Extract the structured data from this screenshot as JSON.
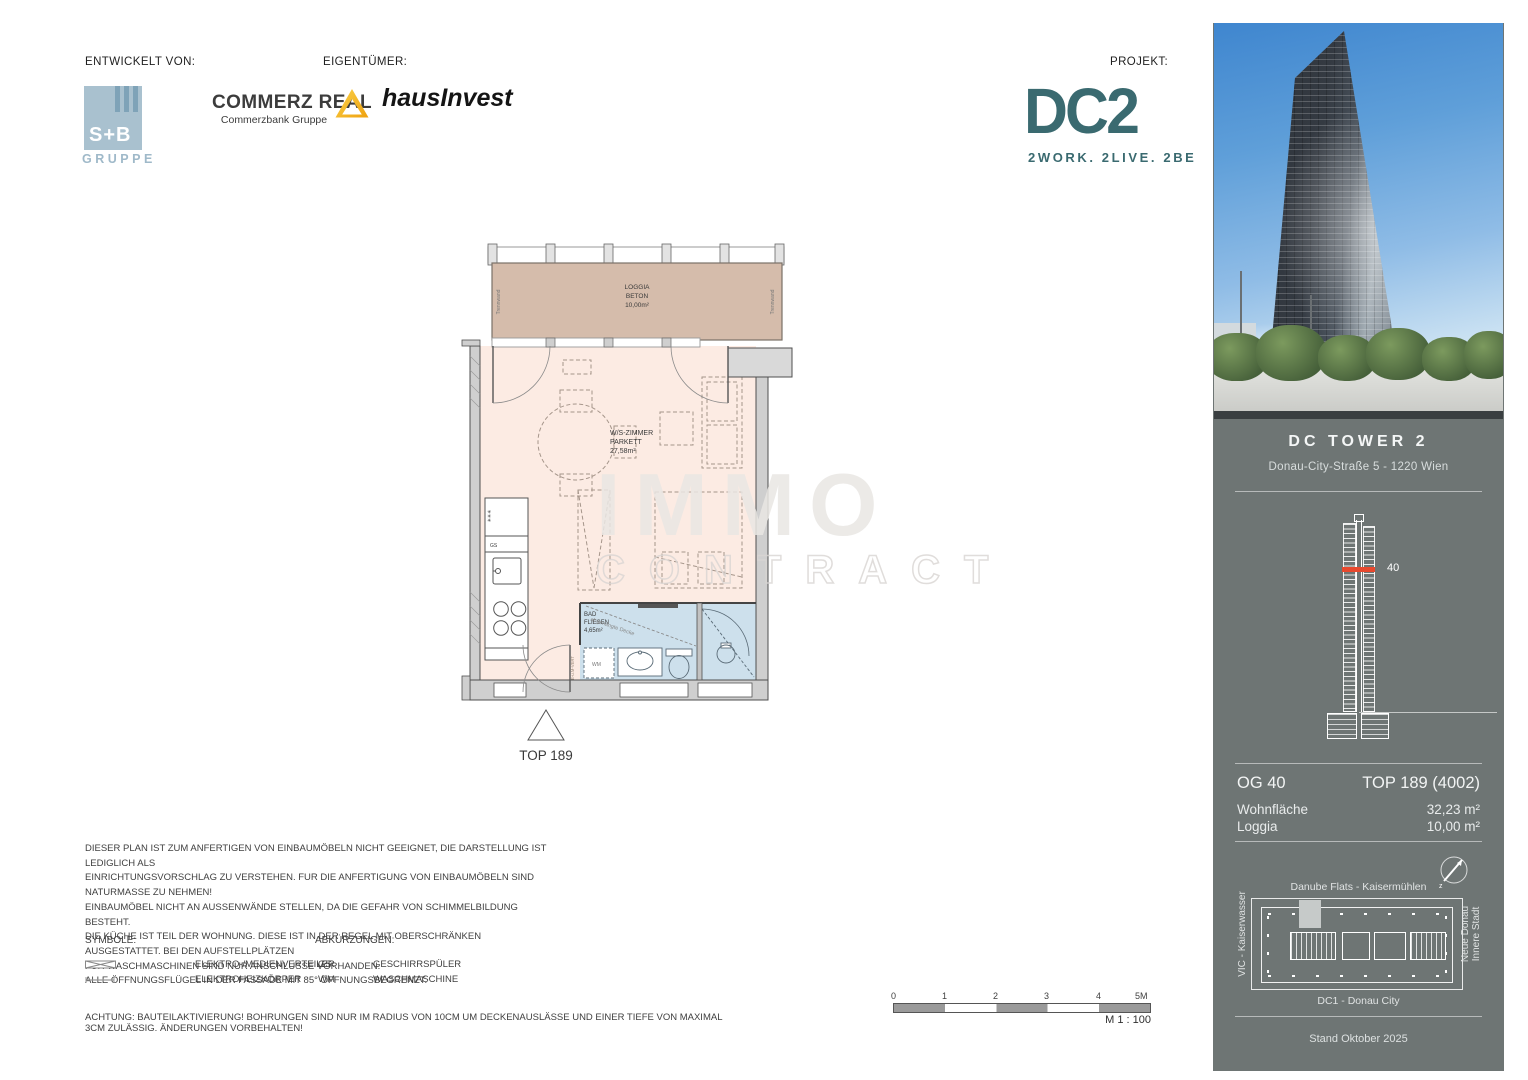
{
  "header": {
    "developed_by_label": "ENTWICKELT VON:",
    "owner_label": "EIGENTÜMER:",
    "project_label": "PROJEKT:",
    "sb_logo": {
      "name": "S+B",
      "sub": "GRUPPE"
    },
    "commerz": {
      "name": "COMMERZ REAL",
      "sub": "Commerzbank Gruppe"
    },
    "hausinvest": "hausInvest",
    "dc2": {
      "name": "DC2",
      "tagline": "2WORK. 2LIVE. 2BE"
    }
  },
  "floorplan": {
    "loggia": {
      "name": "LOGGIA",
      "surface": "BETON",
      "area": "10,00m²"
    },
    "trennwand": "Trennwand",
    "room": {
      "name": "W/S-ZIMMER",
      "surface": "PARKETT",
      "area": "27,58m²"
    },
    "bath": {
      "name": "BAD",
      "surface": "FLIESEN",
      "area": "4,65m²",
      "ceiling_note": "abgehängte Decke"
    },
    "labels": {
      "gs": "GS",
      "wm": "WM",
      "e_vert": "E-u.M-VERT",
      "fridge": "✳✳✳"
    },
    "unit": "TOP 189"
  },
  "watermark": {
    "line1": "IMMO",
    "line2": "CONTRACT"
  },
  "notes": {
    "disclaimer": "DIESER PLAN IST ZUM ANFERTIGEN VON EINBAUMÖBELN NICHT GEEIGNET, DIE DARSTELLUNG IST LEDIGLICH ALS\nEINRICHTUNGSVORSCHLAG ZU VERSTEHEN. FUR DIE ANFERTIGUNG VON EINBAUMÖBELN SIND NATURMASSE ZU NEHMEN!\nEINBAUMÖBEL NICHT AN AUSSENWÄNDE STELLEN, DA DIE GEFAHR VON SCHIMMELBILDUNG BESTEHT.\nDIE KÜCHE IST TEIL DER WOHNUNG. DIESE IST IN DER REGEL MIT OBERSCHRÄNKEN AUSGESTATTET. BEI DEN AUFSTELLPLÄTZEN\nFÜR WASCHMASCHINEN SIND NUR ANSCHLUSSE VORHANDEN.\nALLE ÖFFNUNGSFLÜGEL IN DER FASSADE MIT 85° ÖFFNUNGSBEGRENZT.",
    "symbols_title": "SYMBOLE:",
    "abbreviations_title": "ABKÜRZUNGEN:",
    "symbols": [
      {
        "label": "ELEKTRO-/MEDIENVERTEILER"
      },
      {
        "label": "ELEKTROHEIZKÖRPER"
      }
    ],
    "abbreviations": [
      {
        "key": "GS",
        "label": "GESCHIRRSPÜLER"
      },
      {
        "key": "WM",
        "label": "WASCHMASCHINE"
      }
    ],
    "warning": "ACHTUNG: BAUTEILAKTIVIERUNG! BOHRUNGEN SIND NUR IM RADIUS VON 10CM UM DECKENAUSLÄSSE UND EINER TIEFE VON MAXIMAL 3CM ZULÄSSIG. ÄNDERUNGEN VORBEHALTEN!"
  },
  "scalebar": {
    "ticks": [
      "0",
      "1",
      "2",
      "3",
      "4",
      "5M"
    ],
    "scale_label": "M 1 : 100"
  },
  "sidebar": {
    "title": "DC TOWER 2",
    "address": "Donau-City-Straße 5 - 1220 Wien",
    "floor_marker": "40",
    "unit": {
      "floor": "OG 40",
      "top": "TOP 189 (4002)",
      "living_label": "Wohnfläche",
      "living_value": "32,23 m²",
      "loggia_label": "Loggia",
      "loggia_value": "10,00 m²"
    },
    "siteplan": {
      "top_label": "Danube Flats - Kaisermühlen",
      "left_label": "VIC - Kaiserwasser",
      "right_label": "Neue Donau\nInnere Stadt",
      "bottom_label": "DC1 - Donau City"
    },
    "date": "Stand Oktober 2025"
  },
  "colors": {
    "accent_red": "#E8492E",
    "dc2_teal": "#3A6A70",
    "commerz_yellow": "#F4B519",
    "sb_blue": "#A9C1CF",
    "loggia_fill": "#D5BCAB",
    "room_fill": "#FCEBE3",
    "bath_fill": "#CDE0EC",
    "sidebar_grey": "#6E7574"
  }
}
